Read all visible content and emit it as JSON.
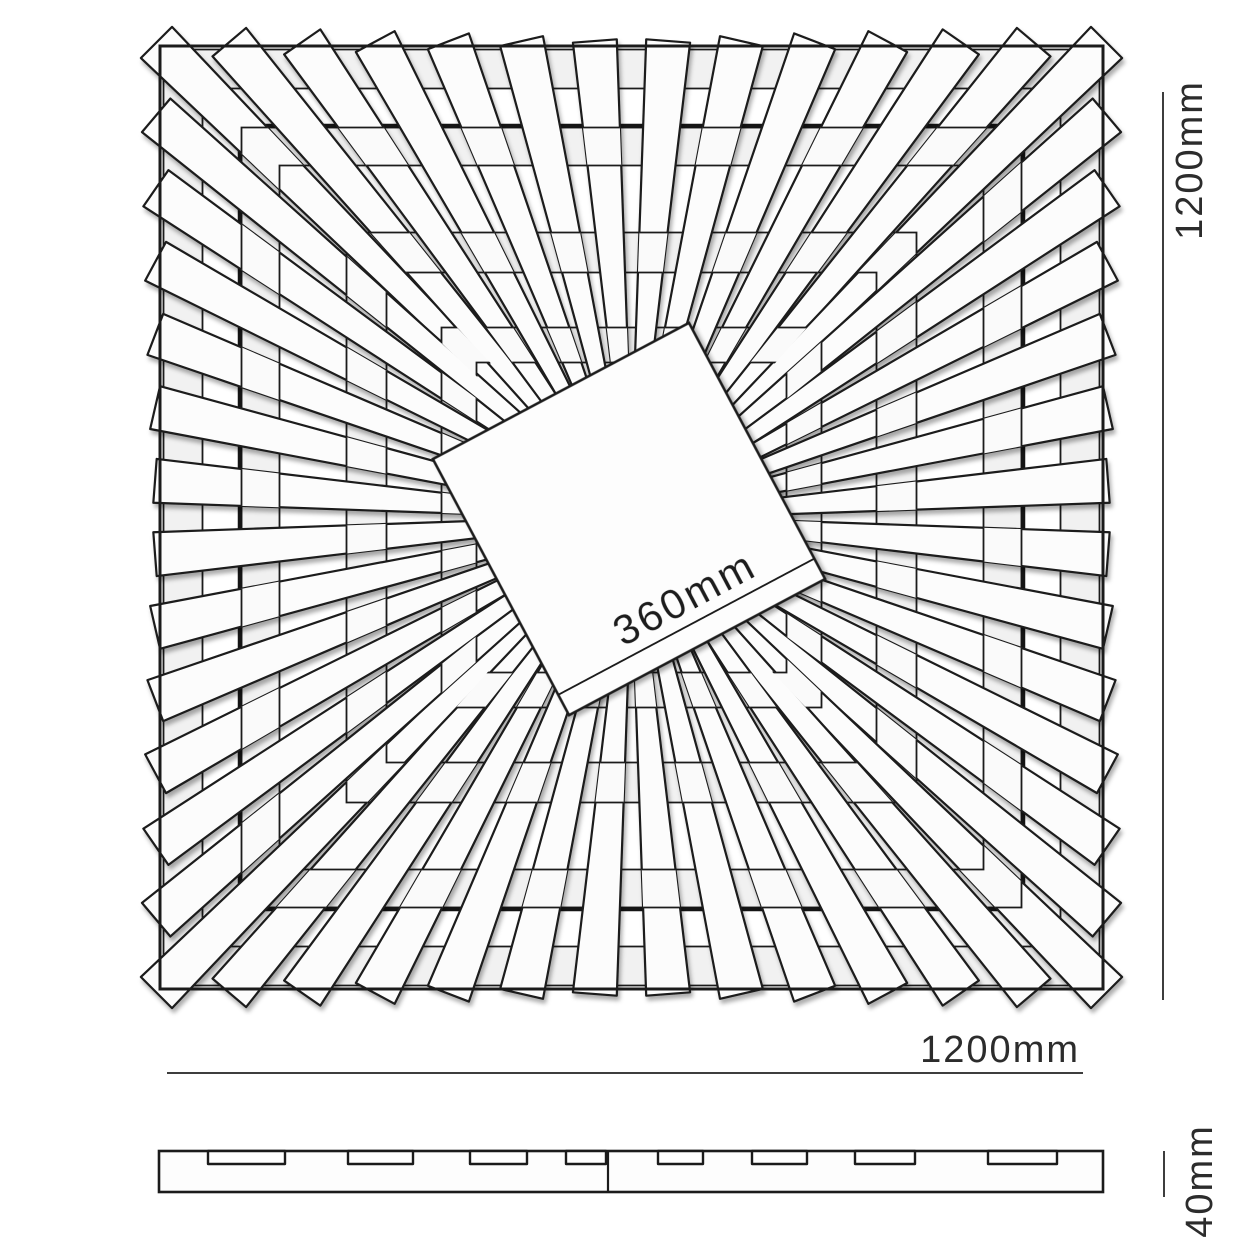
{
  "labels": {
    "height": "1200mm",
    "width": "1200mm",
    "thickness": "40mm",
    "center_size": "360mm"
  },
  "drawing": {
    "center": [
      631.5,
      517.5
    ],
    "outer_size": 943,
    "inner_square_half": 391.5,
    "spokes_per_side": 13,
    "spoke_edge_half_width": 22,
    "spoke_end_overshoot": 5,
    "spoke_start_radius": 128,
    "spoke_start_half_width": 7.5,
    "rings_under": [
      [
        429,
        468
      ],
      [
        352,
        390
      ],
      [
        245,
        285
      ],
      [
        155,
        190
      ]
    ],
    "rings_woven": [
      {
        "band": [
          352,
          390
        ],
        "parity": 0
      },
      {
        "band": [
          245,
          285
        ],
        "parity": 1
      },
      {
        "band": [
          155,
          190
        ],
        "parity": 0
      }
    ],
    "center_square": {
      "side": 290,
      "rotation_deg": -28,
      "edge_line_offset": 23
    },
    "colors": {
      "line": "#1b1b1b",
      "spoke_fill": "#fcfcfc",
      "ring_fill": "#f1f1f1",
      "overlay_fill": "#fafafa",
      "dim_line": "#3d3d3d",
      "text": "#2c2c2c"
    },
    "profile": {
      "x": 159,
      "y": 1151,
      "width": 944,
      "height": 41,
      "divider_x": 608,
      "notch_depth": 13,
      "notches": [
        [
          208,
          77
        ],
        [
          348,
          65
        ],
        [
          470,
          57
        ],
        [
          566,
          40
        ],
        [
          658,
          45
        ],
        [
          752,
          55
        ],
        [
          855,
          60
        ],
        [
          988,
          69
        ]
      ]
    }
  }
}
